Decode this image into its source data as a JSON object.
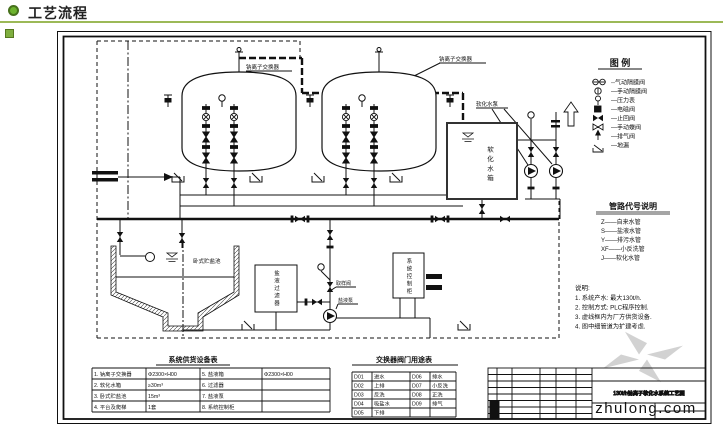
{
  "header": {
    "title": "工艺流程"
  },
  "drawing": {
    "labels": {
      "exchanger_1": "钠离子交换器",
      "exchanger_2": "钠离子交换器",
      "soft_water_tank": "软化水箱",
      "soft_water_pump": "软化水泵",
      "salt_pool": "卧式贮盐池",
      "salt_filter": "盐液过滤器",
      "control_cabinet": "系统控制柜",
      "sampling_valve": "取样阀",
      "salt_pump": "盐液泵"
    },
    "legend": {
      "title": "图  例",
      "items": [
        {
          "icon": "pneumatic-diaphragm-valve-icon",
          "label": "--气动隔膜阀"
        },
        {
          "icon": "manual-diaphragm-valve-icon",
          "label": "—手动隔膜阀"
        },
        {
          "icon": "pressure-gauge-icon",
          "label": "—压力表"
        },
        {
          "icon": "solenoid-valve-icon",
          "label": "—电磁阀"
        },
        {
          "icon": "check-valve-icon",
          "label": "—止回阀"
        },
        {
          "icon": "manual-butterfly-valve-icon",
          "label": "—手动蝶阀"
        },
        {
          "icon": "vent-valve-icon",
          "label": "—排气阀"
        },
        {
          "icon": "floor-drain-icon",
          "label": "—地漏"
        }
      ]
    },
    "pipe_codes": {
      "title": "管路代号说明",
      "items": [
        "Z——自来水管",
        "S——盐液水管",
        "Y——排污水管",
        "XF——小反洗管",
        "J——软化水管"
      ]
    },
    "notes": {
      "title": "说明:",
      "items": [
        "1. 系统产水: 最大130t/h.",
        "2. 控制方式: PLC程序控制.",
        "3. 虚线框内为厂方供货设备.",
        "4. 图中细管道为扩建考虑."
      ]
    },
    "equipment_table": {
      "title": "系统供货设备表",
      "rows": [
        [
          "1. 钠离子交换器",
          "Φ2300×H00",
          "5. 盐液箱",
          "Φ2300×H00"
        ],
        [
          "2. 软化水箱",
          "≥30m³",
          "6. 过滤器",
          ""
        ],
        [
          "3. 卧式贮盐池",
          "15m³",
          "7. 盐液泵",
          ""
        ],
        [
          "4. 平台及爬梯",
          "1套",
          "8. 系统控制柜",
          ""
        ]
      ]
    },
    "valve_table": {
      "title": "交换器阀门用途表",
      "rows": [
        [
          "D01",
          "进水",
          "D06",
          "排水"
        ],
        [
          "D02",
          "上排",
          "D07",
          "小反洗"
        ],
        [
          "D03",
          "反洗",
          "D08",
          "正洗"
        ],
        [
          "D04",
          "吸盐水",
          "D09",
          "排气"
        ],
        [
          "D05",
          "下排",
          "",
          ""
        ]
      ]
    },
    "title_block": {
      "drawing_title": "130t/h钠离子软化水系统工艺图"
    },
    "watermark": {
      "text": "zhulong.com"
    }
  }
}
